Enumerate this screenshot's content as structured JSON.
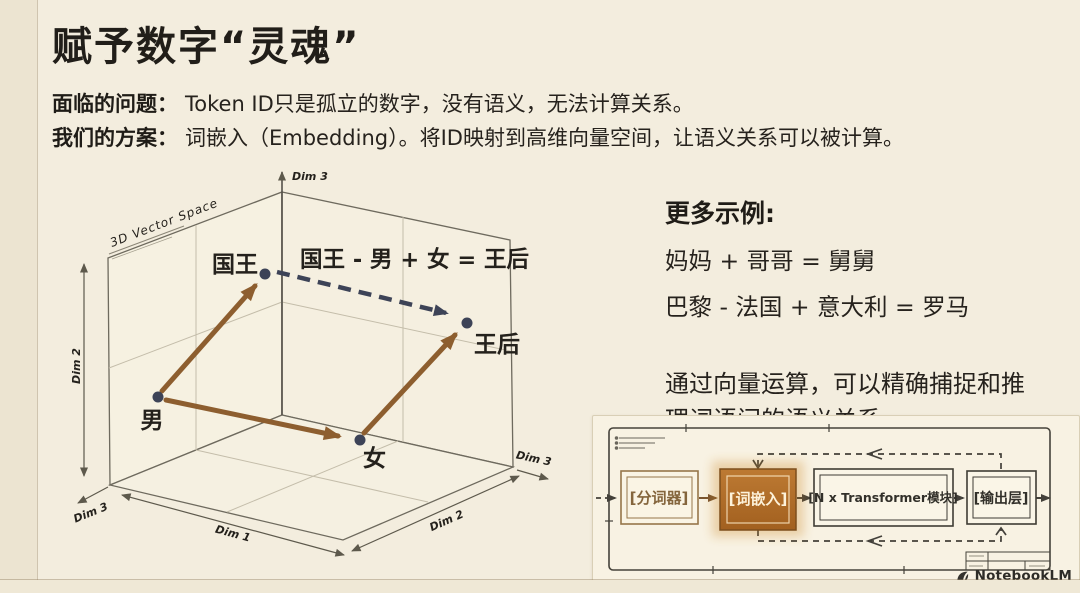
{
  "title": "赋予数字“灵魂”",
  "problem": {
    "label": "面临的问题：",
    "text": "Token ID只是孤立的数字，没有语义，无法计算关系。"
  },
  "solution": {
    "label": "我们的方案：",
    "text": "词嵌入（Embedding）。将ID映射到高维向量空间，让语义关系可以被计算。"
  },
  "vector_chart": {
    "space_label": "3D Vector Space",
    "equation": "国王 - 男 + 女 = 王后",
    "points": {
      "king": "国王",
      "man": "男",
      "woman": "女",
      "queen": "王后"
    },
    "axes": {
      "top": "Dim 3",
      "left": "Dim 2",
      "bottom_left": "Dim 3",
      "bottom_center": "Dim 1",
      "bottom_right": "Dim 2",
      "right": "Dim 3"
    }
  },
  "examples": {
    "heading": "更多示例:",
    "items": [
      "妈妈 + 哥哥 = 舅舅",
      "巴黎 - 法国 + 意大利 = 罗马"
    ],
    "note": "通过向量运算，可以精确捕捉和推理词语间的语义关系。"
  },
  "pipeline": {
    "boxes": [
      {
        "label": "[分词器]",
        "highlighted": false
      },
      {
        "label": "[词嵌入]",
        "highlighted": true
      },
      {
        "label": "[N x Transformer模块]",
        "highlighted": false
      },
      {
        "label": "[输出层]",
        "highlighted": false
      }
    ]
  },
  "watermark": "NotebookLM",
  "colors": {
    "background": "#f3edde",
    "title_text": "#211e19",
    "vector_arrow": "#8d5e2f",
    "dashed_arrow": "#3d4357",
    "highlight_box": "#b0702d"
  }
}
